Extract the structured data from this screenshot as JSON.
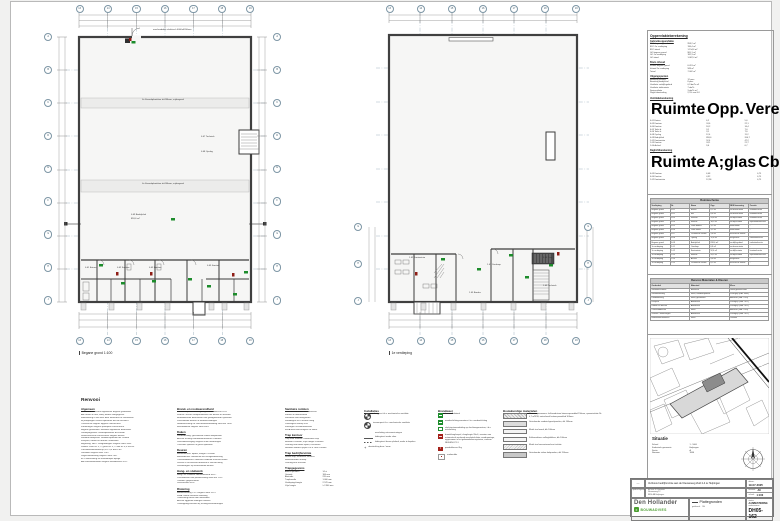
{
  "plans": {
    "left": {
      "caption": "Begane grond 1:100",
      "top_bubbles": [
        "13",
        "14",
        "15",
        "16",
        "17",
        "18",
        "19"
      ],
      "bottom_bubbles": [
        "13",
        "14",
        "15",
        "16",
        "17",
        "18",
        "19"
      ],
      "left_bubbles": [
        "A",
        "B",
        "C",
        "D",
        "E",
        "F",
        "G",
        "H",
        "J"
      ],
      "right_bubbles": [
        "A",
        "B",
        "C",
        "D",
        "E",
        "F",
        "G",
        "H",
        "J"
      ],
      "band1": "4x Kanaalplaatvloer d=260mm, vrijdragend",
      "band2": "4x Kanaalplaatvloer d=260mm, vrijdragend",
      "door_note": "overheaddeur elektrisch 4000x4200mm",
      "labels": [
        "0.07 Techniek",
        "0.08 Opslag",
        "0.09 Bedrijfshal",
        "818,6 m²",
        "0.01 Entree",
        "0.02 Kantoor",
        "0.03 Kantine",
        "0.05 Sanitair"
      ],
      "section_mark": "5"
    },
    "right": {
      "caption": "1e verdieping",
      "top_bubbles": [
        "13",
        "14",
        "15",
        "16",
        "17",
        "18",
        "19"
      ],
      "bottom_bubbles": [
        "13",
        "14",
        "15",
        "16",
        "17",
        "18",
        "19"
      ],
      "left_bubbles": [
        "G",
        "H",
        "J"
      ],
      "right_bubbles": [
        "G",
        "H",
        "J"
      ],
      "labels": [
        "1.02 Kantoortuin",
        "1.01 Overloop",
        "1.04 Trap",
        "1.05 Bordes",
        "1.03 Techniek"
      ]
    }
  },
  "calc": {
    "title": "Oppervlakteberekening",
    "s1": {
      "title": "Gebruiksoppervlakte",
      "rows": [
        [
          "BVO begane grond",
          "958,2 m²"
        ],
        [
          "BVO 1e verdieping",
          "196,4 m²"
        ],
        [
          "BVO totaal",
          "1.154,6 m²"
        ],
        [
          "GO begane grond",
          "905,1 m²"
        ],
        [
          "GO 1e verdieping",
          "182,3 m²"
        ],
        [
          "GO totaal",
          "1.087,4 m²"
        ]
      ]
    },
    "s2": {
      "title": "Bruto inhoud",
      "rows": [
        [
          "Inhoud begane grond",
          "6.413 m³"
        ],
        [
          "Inhoud 1e verdieping",
          "589 m³"
        ],
        [
          "Totaal",
          "7.002 m³"
        ]
      ]
    },
    "s3": {
      "title": "Uitgangspunten",
      "rows": [
        [
          "Bezetting kantoor",
          "12 pers."
        ],
        [
          "Bezetting bedrijfshal",
          "8 pers."
        ],
        [
          "Ventilatie verblijfsgebied",
          "0,9 dm³/s·m²"
        ],
        [
          "Ventilatie toiletruimte",
          "7 dm³/s"
        ],
        [
          "Spuiventilatie",
          "3 dm³/s·m²"
        ],
        [
          "Daglichttoetreding",
          "2,5% van GO"
        ]
      ]
    },
    "vent": {
      "title": "Ventilatieberekening",
      "headers": [
        "Ruimte",
        "Opp.",
        "Vereist",
        "Toevoer",
        "Afvoer",
        "Voorz."
      ],
      "rows": [
        [
          "0.01 Entree",
          "6,2",
          "5,6",
          "mech.",
          "mech.",
          "WTW"
        ],
        [
          "0.03 Kantoor",
          "24,6",
          "22,1",
          "mech.",
          "mech.",
          "WTW"
        ],
        [
          "0.04 Kantine",
          "18,2",
          "16,4",
          "mech.",
          "mech.",
          "WTW"
        ],
        [
          "0.05 Toilet d.",
          "3,1",
          "7,0",
          "overstr.",
          "mech.",
          "MV"
        ],
        [
          "0.06 Toilet h.",
          "3,1",
          "7,0",
          "overstr.",
          "mech.",
          "MV"
        ],
        [
          "0.08 Opslag",
          "12,4",
          "11,2",
          "natuurl.",
          "mech.",
          "MV"
        ],
        [
          "0.09 Bedrijfshal",
          "818,6",
          "204,7",
          "natuurl.",
          "mech.",
          "MV"
        ],
        [
          "1.02 Kantoortuin",
          "52,4",
          "47,2",
          "mech.",
          "mech.",
          "WTW"
        ],
        [
          "1.03 Kantine",
          "24,1",
          "21,7",
          "mech.",
          "mech.",
          "WTW"
        ],
        [
          "1.04 Archief",
          "9,6",
          "6,7",
          "overstr.",
          "mech.",
          "MV"
        ]
      ]
    },
    "daglicht": {
      "title": "Daglichtberekening",
      "headers": [
        "Ruimte",
        "A;glas",
        "Cb",
        "Cu",
        "A;eq",
        "Vereist",
        "Aanw.",
        "%"
      ],
      "rows": [
        [
          "0.03 Kantoor",
          "6,48",
          "0,75",
          "0,80",
          "3,89",
          "2,46 m²",
          "3,89 m²",
          "15,8%"
        ],
        [
          "0.04 Kantine",
          "4,32",
          "0,75",
          "0,80",
          "2,59",
          "1,82 m²",
          "2,59 m²",
          "14,2%"
        ],
        [
          "1.02 Kantoortuin",
          "12,96",
          "0,75",
          "0,80",
          "7,78",
          "5,24 m²",
          "7,78 m²",
          "14,8%"
        ]
      ]
    }
  },
  "ruimteschema": {
    "title": "Ruimteschema",
    "headers": [
      "Verdieping",
      "Nr.",
      "Naam",
      "Opp.",
      "NEN benaming",
      "Functie"
    ],
    "rows": [
      [
        "Begane grond",
        "0.01",
        "Entree",
        "6,2 m²",
        "verkeersruimte",
        "kantoorfunctie"
      ],
      [
        "Begane grond",
        "0.02",
        "Hal",
        "8,4 m²",
        "verkeersruimte",
        "kantoorfunctie"
      ],
      [
        "Begane grond",
        "0.03",
        "Kantoor",
        "24,6 m²",
        "verblijfsruimte",
        "kantoorfunctie"
      ],
      [
        "Begane grond",
        "0.04",
        "Kantine",
        "18,2 m²",
        "verblijfsruimte",
        "bijeenkomstfunctie"
      ],
      [
        "Begane grond",
        "0.05",
        "Toilet dames",
        "3,1 m²",
        "toiletruimte",
        "-"
      ],
      [
        "Begane grond",
        "0.06",
        "Toilet heren",
        "3,1 m²",
        "toiletruimte",
        "-"
      ],
      [
        "Begane grond",
        "0.07",
        "Technische ruimte",
        "5,8 m²",
        "technische ruimte",
        "-"
      ],
      [
        "Begane grond",
        "0.08",
        "Opslag",
        "12,4 m²",
        "bergruimte",
        "industriefunctie"
      ],
      [
        "Begane grond",
        "0.09",
        "Bedrijfshal",
        "818,6 m²",
        "verblijfsgebied",
        "industriefunctie"
      ],
      [
        "1e verdieping",
        "1.01",
        "Overloop",
        "6,8 m²",
        "verkeersruimte",
        "-"
      ],
      [
        "1e verdieping",
        "1.02",
        "Kantoortuin",
        "52,4 m²",
        "verblijfsruimte",
        "kantoorfunctie"
      ],
      [
        "1e verdieping",
        "1.03",
        "Kantine",
        "24,1 m²",
        "verblijfsruimte",
        "bijeenkomstfunctie"
      ],
      [
        "1e verdieping",
        "1.04",
        "Archief",
        "9,6 m²",
        "bergruimte",
        "-"
      ],
      [
        "1e verdieping",
        "1.05",
        "Technische ruimte",
        "8,2 m²",
        "technische ruimte",
        "-"
      ]
    ]
  },
  "materialen": {
    "title": "Renvooi Materialen & Kleuren",
    "headers": [
      "Onderdeel",
      "Materiaal",
      "Kleur"
    ],
    "rows": [
      [
        "Gevelmetselwerk",
        "Baksteen",
        "Rood genuanceerd"
      ],
      [
        "Gevelbekleding",
        "Staal, sandwichpaneel",
        "Zilvergrijs (RAL 9006)"
      ],
      [
        "Dakbedekking",
        "Staal, geïsoleerd",
        "Antraciet (RAL 7016)"
      ],
      [
        "Kozijnen",
        "Aluminium",
        "Zwartgrijs (RAL 7021)"
      ],
      [
        "Ramen en deuren",
        "Aluminium",
        "Zwartgrijs (RAL 7021)"
      ],
      [
        "Overheaddeuren",
        "Staal",
        "Antraciet (RAL 7016)"
      ],
      [
        "Zetwerk / waterslagen",
        "Aluminium",
        "Zwartgrijs (RAL 7021)"
      ],
      [
        "Hemelwaterafvoeren",
        "Staal",
        "Verzinkt"
      ]
    ]
  },
  "situatie": {
    "title": "Situatie",
    "rows": [
      [
        "Schaal",
        "1 : 1000"
      ],
      [
        "Kadastrale gemeente",
        "Helpingen"
      ],
      [
        "Sectie",
        "A"
      ],
      [
        "Nummer",
        "1846"
      ]
    ]
  },
  "titleblock": {
    "rev_mark": "—",
    "project": "Verbouw bedrijfsruimte aan de Nieuweweg Zuid 2-4 te Helpingen",
    "client_label": "opdrachtgever:",
    "client_lines": [
      "de heer R. Roossen",
      "Nieuweweg 12",
      "8854 AB Helpingen"
    ],
    "date_label": "datum:",
    "date": "19-07-2025",
    "format_label": "formaat:",
    "format": "A0",
    "scale_label": "schaal:",
    "scale": "1:100",
    "status_label": "status:",
    "status": "AANBESTEDING",
    "number_label": "werknummer:",
    "number": "DH05-162",
    "company": "Den Hollander",
    "company_sub": "BOUWADVIES",
    "subject_label": "onderwerp:",
    "subject": "Plattegronden",
    "drawn_label": "getekend:",
    "drawn": "DH"
  },
  "renvooi": {
    "title": "Renvooi",
    "algemeen": {
      "title": "Algemeen",
      "lines": [
        "Peil = 0 = bovenkant afgewerkte begane grondvloer",
        "Alle maten in mm, tenzij anders aangegeven",
        "Maatvoering in het werk door aannemer te controleren",
        "Bij afwijkingen contact opnemen met de architect",
        "Constructie volgens opgave constructeur",
        "Funderingen volgens palenplan constructeur",
        "Begane grondvloer: monoliet afgewerkte betonvloer",
        "Verdiepingsvloer: kanaalplaatvloer d=260mm",
        "Staalconstructie conserveren volgens bestek",
        "Wanden bedrijfshal: sandwichpanelen dik 100mm",
        "Kozijnen, ramen en deuren: aluminium",
        "Beglazing: HR++ veiligheidsglas volgens NEN 3569",
        "Isolatie: vloer Rc 3,7 / gevel Rc 4,7 / dak Rc 6,3 m²K/W",
        "Luchtdoorlatendheid qv;10 ≤ 0,4 dm³/s·m²",
        "Ventilatie volgens NEN 1087",
        "Daglichttoetreding volgens NEN 2057",
        "EPC-berekening zie afzonderlijke bijlage",
        "Alle werkzaamheden volgens Bouwbesluit 2012"
      ]
    },
    "brand": {
      "title": "Brand- en rookwerendheid",
      "lines": [
        "Brandcompartimentering volgens Bouwbesluit 2012",
        "WBDBO tussen compartimenten ten minste 60 minuten",
        "Brandwerende doorvoeren met goedgekeurde systemen",
        "Zelfsluitende deuren in brandscheidingen",
        "Noodverlichting en vluchtrouteaanduiding NEN-EN 1838",
        "Blusmiddelen volgens NEN 4001"
      ]
    },
    "daken": {
      "title": "Daken",
      "lines": [
        "Dakbedekking: geïsoleerde stalen dakpanelen",
        "Afschot richting hemelwaterafvoeren 10mm/m",
        "Doorvalbeveiliging volgens RI&E aanbrengen",
        "Overstort spuwers in gevel opnemen"
      ]
    },
    "deuren": {
      "title": "Deuren",
      "lines": [
        "Binnendeuren: opdek, hoogte 2315mm",
        "Buitendeuren: aluminium met veiligheidsbeslag",
        "Overheaddeuren: elektrisch bediend 4000x4200mm",
        "Deuren in vluchtroute draaiend in vluchtrichting",
        "Deurdrangers op zelfsluitende deuren"
      ]
    },
    "hangsluit": {
      "title": "Hang- en sluitwerk",
      "lines": [
        "Hang- en sluitwerk inbraakwerend SKG**",
        "Vluchtdeuren met panieksluiting NEN-EN 1125",
        "Cilinders gelijksluitend",
        "Deurkrukken RVS"
      ]
    },
    "riolering": {
      "title": "Riolering",
      "lines": [
        "Binnenriolering PVC volgens NEN 3215",
        "HWA: stalen afvoeren inwendig",
        "Ontluchting boven dak uitmonden",
        "Afschot liggende leidingen 5mm/m",
        "Ontstoppingsstukken bij richtingsveranderingen"
      ]
    },
    "sanitair": {
      "title": "Sanitaire ruimten",
      "lines": [
        "Wandcloset met inbouwreservoir",
        "Fontein in toiletruimten",
        "Wastafels met mengkraan",
        "Wandtegels tot 1500mm hoog",
        "Vloertegels antislip R10",
        "Kitvoegen schimmelwerend",
        "MIVA-toilet met beugels en alarm"
      ]
    },
    "trap_kantoor": {
      "title": "Trap kantoor",
      "lines": [
        "Trap naar kantoor: hardhouten trap",
        "Breedte 1000mm, vrije hoogte 2300mm",
        "Leuning aan beide zijden, h=900mm",
        "Hekwerk bordes spijlen h.o.h. max 100mm"
      ]
    },
    "trap_bedrijf": {
      "title": "Trap bedrijfsruimte",
      "lines": [
        "Stalen trap, thermisch verzinkt",
        "Roostertreden antislip",
        "Leuning buis Ø42mm"
      ]
    },
    "trap_table_title": "Trapgegevens",
    "trap_table": {
      "rows": [
        [
          "Aantal optreden",
          "14 st"
        ],
        [
          "Optrede",
          "184 mm"
        ],
        [
          "Aantrede",
          "220 mm"
        ],
        [
          "Trapbreedte",
          "1.000 mm"
        ],
        [
          "Verdiepingshoogte",
          "2.576 mm"
        ],
        [
          "Vrije hoogte",
          "≥ 2.300 mm"
        ]
      ]
    }
  },
  "legend": {
    "installaties": {
      "title": "Installaties",
      "rows": [
        {
          "text": "afzuigpunt t.b.v. mechanische ventilatie"
        },
        {
          "text": "toevoerpunt t.b.v. mechanische ventilatie"
        },
        {
          "text": "aansluiting nutsvoorzieningen"
        },
        {
          "text": "leidingtracé onder vloer"
        },
        {
          "text": "leidingtracé boven plafond, nader te bepalen"
        },
        {
          "text": "draairichting deur / raam"
        }
      ]
    },
    "brandweer": {
      "title": "Brandweer",
      "rows": [
        {
          "text": "deur zelfsluitend"
        },
        {
          "text": "noodverlichtingsarmatuur t.b.v. noodverlichting"
        },
        {
          "text": "vluchtrouteaanduiding op vluchtwegarmatuur, t.b.v. ontvluchting"
        },
        {
          "text": "brandslanghaspel, slanglengte 20m1, voorzien van automatisch werkende aansluitafsluiter, wandmontage, opgenomen in het gebouwbeheersysteem, conform NEN-EN 671-1"
        },
        {
          "text": "poederblusser 6kg"
        },
        {
          "text": "rookmelder"
        }
      ]
    },
    "bouwkundig": {
      "title": "Bouwkundige materialen",
      "rows": [
        {
          "text": "Nieuwe spouwmuur: kalkzandsteen binnenspouwblad 150mm, spouwisolatie Rc 4,7 m²K/W, metselwerk buitenspouwblad 100mm"
        },
        {
          "text": "Geïsoleerde sandwichgevelpanelen, dik 100mm"
        },
        {
          "text": "Metal stud wand, dik 100mm"
        },
        {
          "text": "Kalkzandsteen vellingblokken, dik 100mm"
        },
        {
          "text": "Metal stud voorzetwand met isolatie"
        },
        {
          "text": "Geïsoleerde stalen dakpanelen, dik 150mm"
        }
      ]
    }
  },
  "colors": {
    "exit_green": "#1d8c2c",
    "alarm_red": "#a32019",
    "wall": "#404040",
    "grid_blue": "#a3b6c2",
    "logo_green": "#4a9e2f"
  }
}
